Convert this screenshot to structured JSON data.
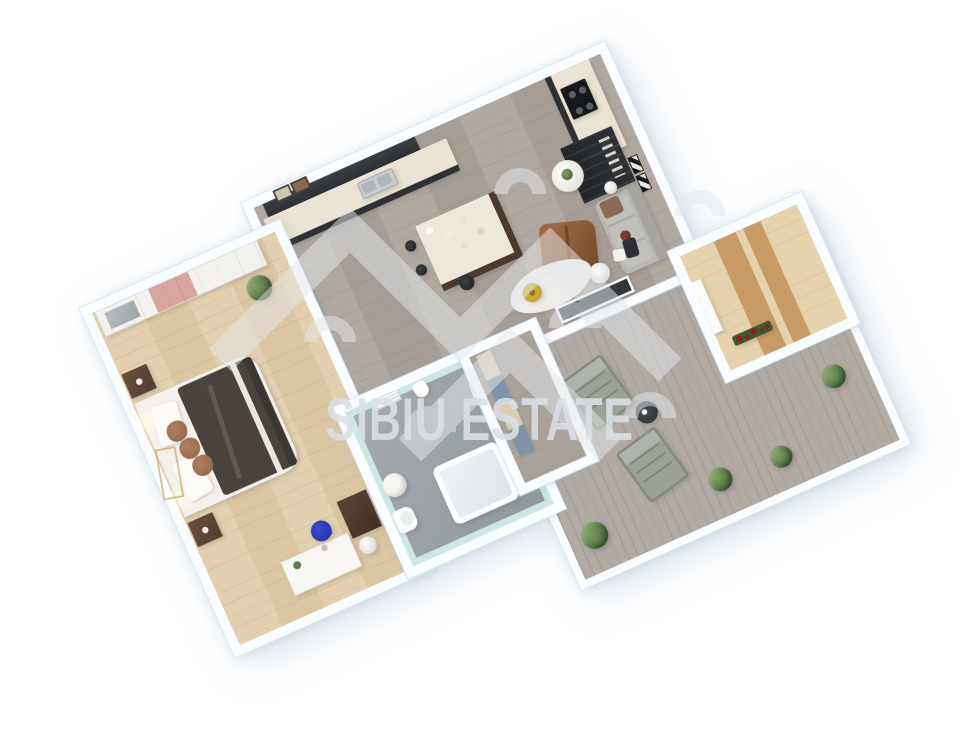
{
  "meta": {
    "kind": "3d-floor-plan-render",
    "view": "rotated top-down isometric, apartment with terrace",
    "rotation_deg": -24
  },
  "watermark": {
    "text": "SIBIU ESTATE",
    "logo": "double-roofline-zigzag-with-arch-doorways",
    "color": "#dbe0e5"
  },
  "palette": {
    "background": "#ffffff",
    "wall": "#fafdff",
    "wall_edge": "#d6e3ee",
    "bedroom_floor": "#e0cca9",
    "living_floor": "#aca49c",
    "bathroom_wall": "#cde8e2",
    "bathroom_floor": "#9aa1a5",
    "hallway_floor": "#a9a29b",
    "balcony_deck": "#b2aba4",
    "entry_floor": "#e6d3ae",
    "wood_slat": "#c89a66",
    "kitchen_dark": "#2e3134",
    "counter_top": "#eae2d2",
    "island_top": "#eee8dc",
    "island_base": "#4a3a30",
    "sofa_gray": "#b9b7b3",
    "cushion_brown": "#8a6a52",
    "lounge_brown": "#8a5a38",
    "bed_white": "#f4f1ec",
    "bed_duvet": "#4a433d",
    "pillow_brown": "#9a6b50",
    "wardrobe_white": "#f4f2ee",
    "wardrobe_pink": "#d8a49e",
    "nightstand_brown": "#513d30",
    "desk_white": "#f7f6f3",
    "chair_blue": "#2837b0",
    "mint_lining": "#cde8e2",
    "closet_beige": "#d9cdb4",
    "closet_blue": "#7d93aa",
    "lounger_gray": "#9ba195",
    "deck_table_dark": "#33383b",
    "plant_green": "#5d7a4c",
    "plant_dark": "#3f5a2e",
    "flower_red": "#8f1f24",
    "pouf_yellow": "#d9b93c",
    "glass_dark": "#3d4448",
    "door_gray": "#b9bcbe",
    "console_dark": "#2b2e31",
    "watermark_color": "#dbe0e5"
  },
  "rooms": [
    {
      "id": "living-kitchen",
      "label": "open living room with L-shaped kitchen, island, sofa and tall cabinet",
      "floor": "gray wood planks"
    },
    {
      "id": "bedroom",
      "label": "bedroom with wardrobe, double bed, desk and blue chair",
      "floor": "light oak planks"
    },
    {
      "id": "bathroom",
      "label": "bathroom with bathtub, pedestal sink and toilet",
      "floor": "gray",
      "walls": "mint"
    },
    {
      "id": "hallway",
      "label": "hallway with beige and blue closet modules",
      "floor": "gray wood"
    },
    {
      "id": "entry",
      "label": "small entry room with slatted wood floor",
      "floor": "warm wood slats"
    },
    {
      "id": "balcony",
      "label": "large terrace with two loungers, round table and planters",
      "floor": "gray decking"
    }
  ],
  "furniture": {
    "living": [
      "upper-cabinets",
      "kitchen-counter-with-sink",
      "stove-counter",
      "tall-cabinet",
      "kitchen-island-with-dishes",
      "bar-stools",
      "island-chair",
      "gray-sofa",
      "person-on-sofa",
      "brown-lounge-chair",
      "pedestal-plant-table",
      "white-rug",
      "yellow-pouf",
      "coffee-table",
      "side-table",
      "wall-art-frames",
      "picture-frames",
      "gray-door",
      "black-console-shelf",
      "balcony-glass-door"
    ],
    "bedroom": [
      "wardrobe-white-pink",
      "double-bed-dark-duvet",
      "pillows",
      "brown-cushions",
      "bedside-lamps-glow",
      "nightstand-north",
      "nightstand-south",
      "plant",
      "dark-dresser",
      "white-desk",
      "blue-desk-chair",
      "white-chair",
      "gold-ladder-decor"
    ],
    "bathroom": [
      "bathtub",
      "pedestal-sink",
      "toilet",
      "vent-grille",
      "towel",
      "hanging-robe"
    ],
    "hallway": [
      "closet-module-beige",
      "closet-module-blue",
      "closet-module-beige-2",
      "closet-module-blue-2"
    ],
    "entry": [
      "wall-shelf",
      "red-flower-box"
    ],
    "balcony": [
      "lounger-1",
      "lounger-2",
      "round-deck-table",
      "shrub-planters",
      "red-flower-box"
    ]
  }
}
